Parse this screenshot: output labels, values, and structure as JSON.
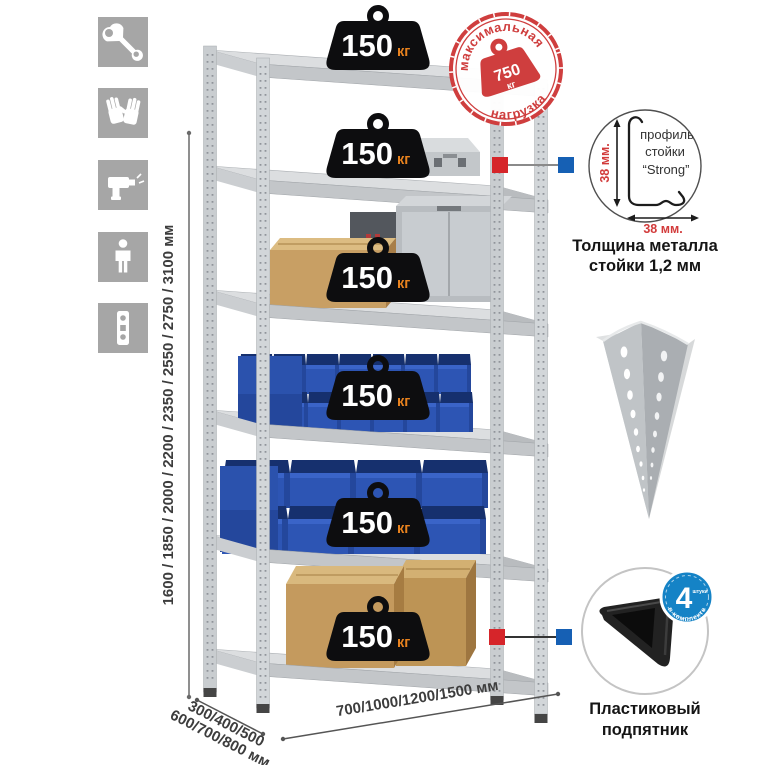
{
  "sidebar": {
    "icons": [
      {
        "name": "wrench"
      },
      {
        "name": "gloves"
      },
      {
        "name": "drill"
      },
      {
        "name": "person"
      },
      {
        "name": "perforated-profile"
      }
    ]
  },
  "dimensions": {
    "height": "1600 / 1850 / 2000 / 2200 / 2350 / 2550 / 2750 / 3100 мм",
    "depth_line1": "300/400/500",
    "depth_line2": "600/700/800 мм",
    "width": "700/1000/1200/1500 мм"
  },
  "stamp": {
    "arc_top": "максимальная",
    "arc_bottom": "нагрузка",
    "value": "750",
    "unit": "кг"
  },
  "weights": {
    "value": "150",
    "unit": "кг",
    "count": 6
  },
  "profile_detail": {
    "line1": "профиль",
    "line2": "стойки",
    "line3": "“Strong”",
    "dim_v": "38 мм.",
    "dim_h": "38 мм.",
    "caption1": "Толщина металла",
    "caption2": "стойки 1,2 мм"
  },
  "foot_detail": {
    "badge_number": "4",
    "badge_small": "штуки",
    "badge_arc": "в комплекте",
    "caption1": "Пластиковый",
    "caption2": "подпятник"
  },
  "colors": {
    "stamp_red": "#cf3e3e",
    "callout_red": "#d6252a",
    "callout_blue": "#1660b4",
    "badge_blue": "#1583c6",
    "bin_blue": "#2d55b4",
    "weight_unit_orange": "#e8821e",
    "metal_gray": "#c9cdd0"
  }
}
